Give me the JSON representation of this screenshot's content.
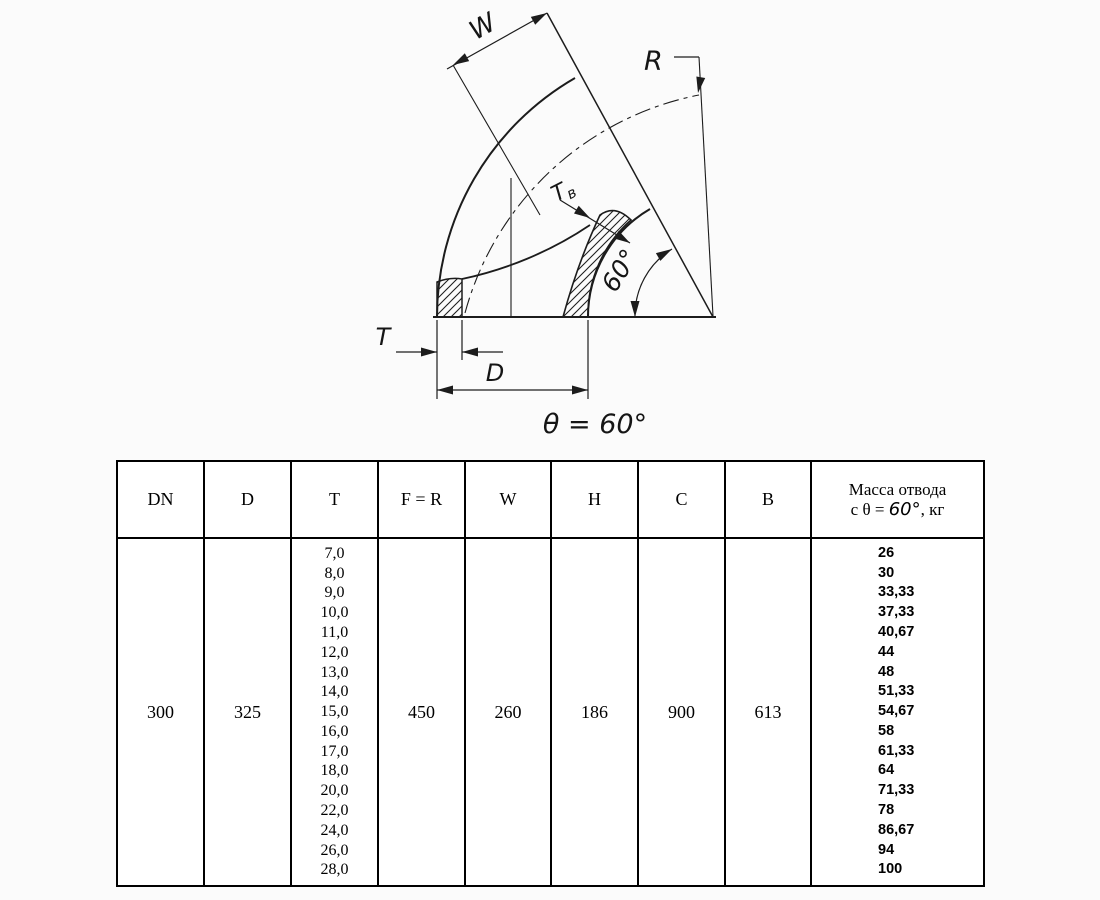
{
  "drawing": {
    "labels": {
      "w": "W",
      "r": "R",
      "tv_main": "T",
      "tv_sub": "в",
      "angle": "60°",
      "t": "T",
      "d": "D",
      "theta": "θ = 60°"
    }
  },
  "table": {
    "headers": [
      "DN",
      "D",
      "T",
      "F = R",
      "W",
      "H",
      "C",
      "B"
    ],
    "mass_header": {
      "line1": "Масса отвода",
      "prefix": "с θ = ",
      "angle": "60°",
      "suffix": ", кг"
    },
    "row": {
      "dn": "300",
      "d": "325",
      "f_r": "450",
      "w": "260",
      "h": "186",
      "c": "900",
      "b": "613",
      "t_values": [
        "7,0",
        "8,0",
        "9,0",
        "10,0",
        "11,0",
        "12,0",
        "13,0",
        "14,0",
        "15,0",
        "16,0",
        "17,0",
        "18,0",
        "20,0",
        "22,0",
        "24,0",
        "26,0",
        "28,0"
      ],
      "mass_values": [
        "26",
        "30",
        "33,33",
        "37,33",
        "40,67",
        "44",
        "48",
        "51,33",
        "54,67",
        "58",
        "61,33",
        "64",
        "71,33",
        "78",
        "86,67",
        "94",
        "100"
      ]
    }
  }
}
